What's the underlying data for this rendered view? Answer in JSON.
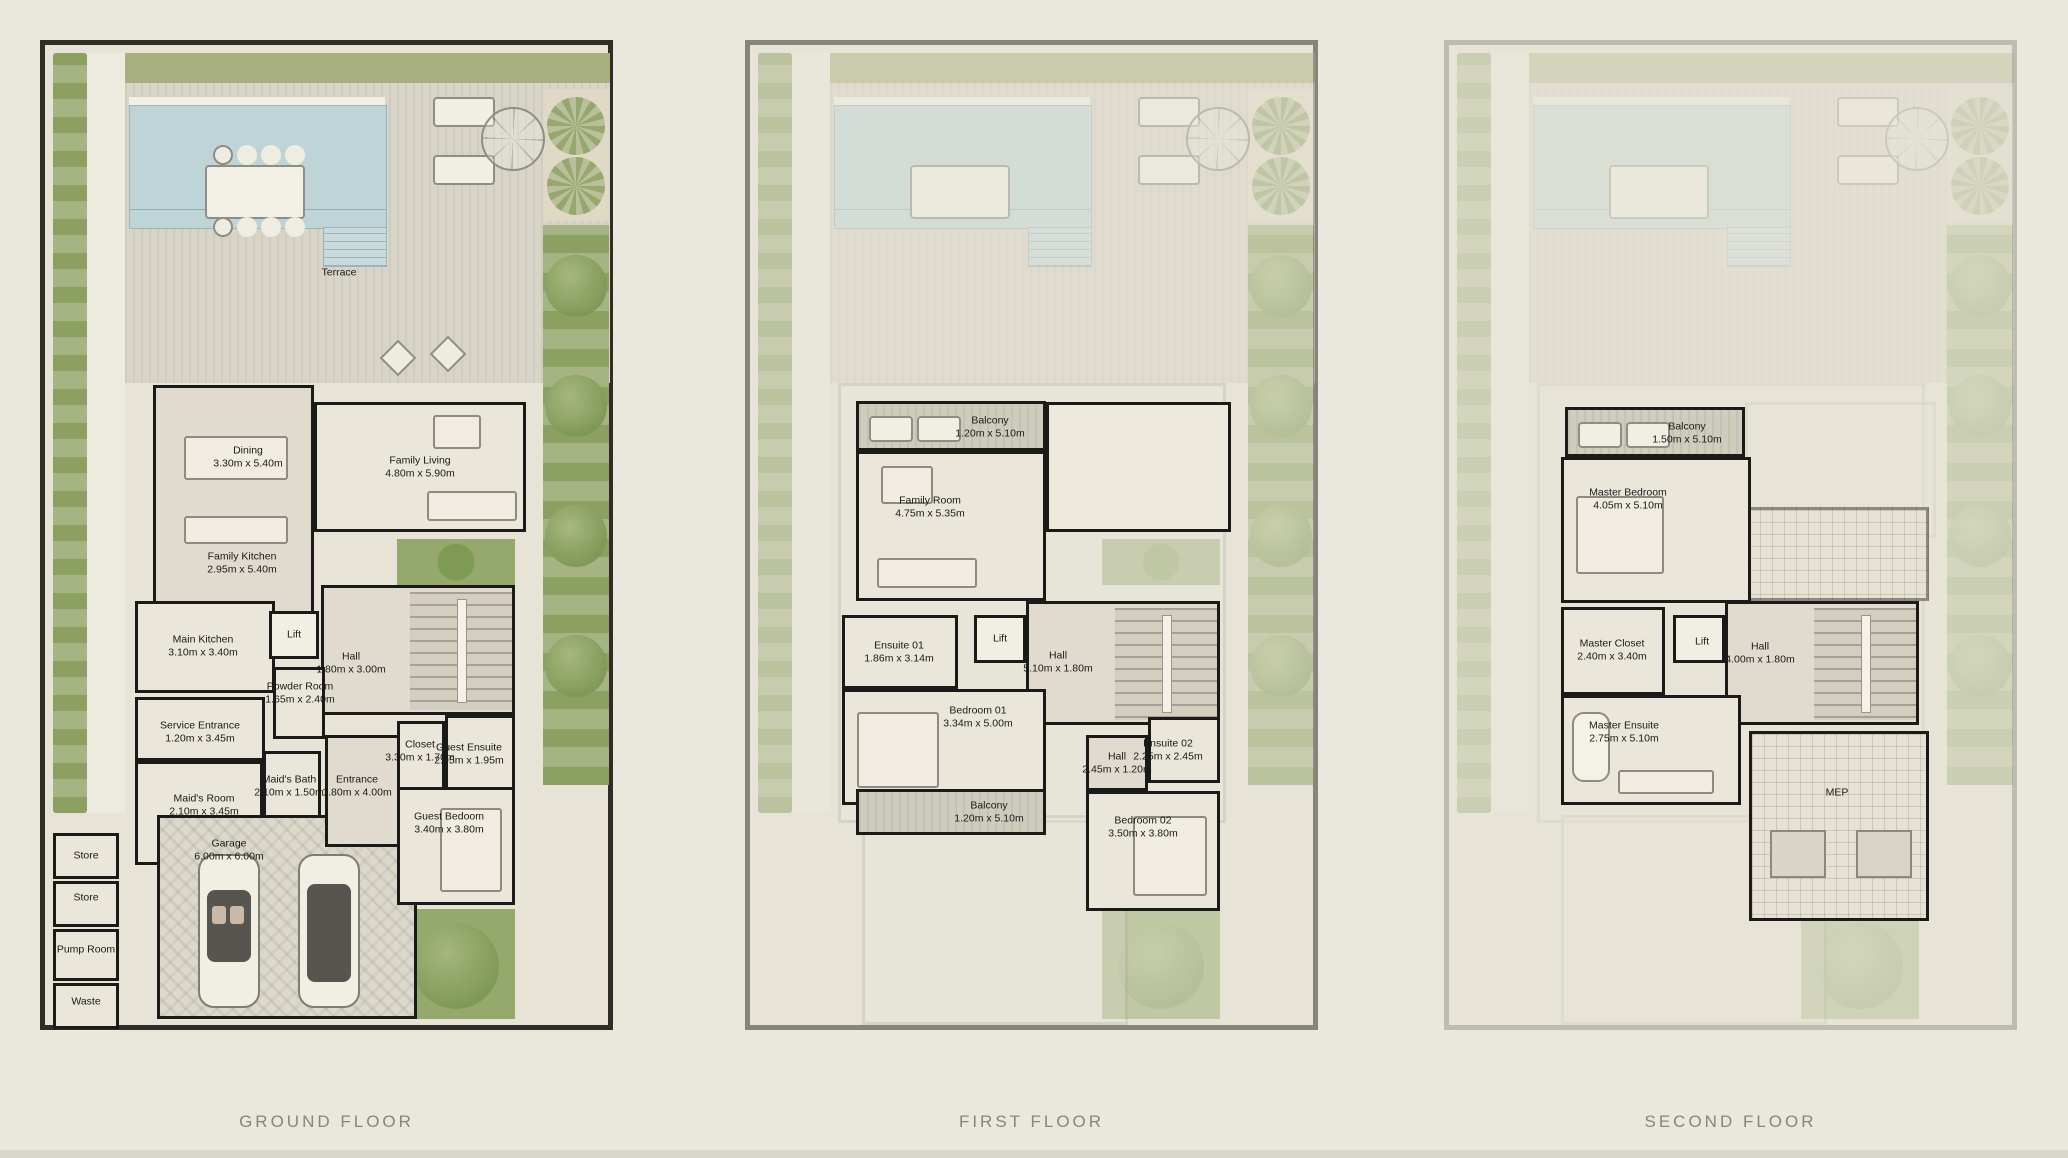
{
  "page": {
    "background_color": "#eae7dd",
    "description_labels": [
      "Terrace"
    ]
  },
  "colors": {
    "wall": "#1a1a18",
    "pool": "#bed4d6",
    "greenery": "#9fae78",
    "deck": "#d8d5c8",
    "frame_ground": "#2e2d29",
    "frame_first": "#85847e",
    "frame_second": "#bdbbb2",
    "title_text": "#8d8379",
    "label_text": "#191919"
  },
  "floors": [
    {
      "id": "ground",
      "title": "GROUND FLOOR",
      "labels": [
        {
          "name": "Terrace",
          "dims": "",
          "x": 294,
          "y": 228
        },
        {
          "name": "Dining",
          "dims": "3.30m x 5.40m",
          "x": 203,
          "y": 412
        },
        {
          "name": "Family Living",
          "dims": "4.80m x 5.90m",
          "x": 375,
          "y": 422
        },
        {
          "name": "Family Kitchen",
          "dims": "2.95m x 5.40m",
          "x": 197,
          "y": 518
        },
        {
          "name": "Main Kitchen",
          "dims": "3.10m x 3.40m",
          "x": 158,
          "y": 601
        },
        {
          "name": "Lift",
          "dims": "",
          "x": 249,
          "y": 590
        },
        {
          "name": "Hall",
          "dims": "1.80m x 3.00m",
          "x": 306,
          "y": 618
        },
        {
          "name": "Powder Room",
          "dims": "1.65m x 2.40m",
          "x": 255,
          "y": 648
        },
        {
          "name": "Service Entrance",
          "dims": "1.20m x 3.45m",
          "x": 155,
          "y": 687
        },
        {
          "name": "Maid's Bath",
          "dims": "2.10m x 1.50m",
          "x": 244,
          "y": 741
        },
        {
          "name": "Maid's Room",
          "dims": "2.10m x 3.45m",
          "x": 159,
          "y": 760
        },
        {
          "name": "Entrance",
          "dims": "1.80m x 4.00m",
          "x": 312,
          "y": 741
        },
        {
          "name": "Closet",
          "dims": "3.30m x 1.70m",
          "x": 375,
          "y": 706
        },
        {
          "name": "Guest Ensuite",
          "dims": "2.95m x 1.95m",
          "x": 424,
          "y": 709
        },
        {
          "name": "Guest Bedoom",
          "dims": "3.40m x 3.80m",
          "x": 404,
          "y": 778
        },
        {
          "name": "Garage",
          "dims": "6.00m x 6.00m",
          "x": 184,
          "y": 805
        },
        {
          "name": "Store",
          "dims": "",
          "x": 41,
          "y": 811
        },
        {
          "name": "Store",
          "dims": "",
          "x": 41,
          "y": 853
        },
        {
          "name": "Pump Room",
          "dims": "",
          "x": 41,
          "y": 905
        },
        {
          "name": "Waste",
          "dims": "",
          "x": 41,
          "y": 957
        }
      ]
    },
    {
      "id": "first",
      "title": "FIRST FLOOR",
      "labels": [
        {
          "name": "Balcony",
          "dims": "1.20m x 5.10m",
          "x": 240,
          "y": 382
        },
        {
          "name": "Family Room",
          "dims": "4.75m x 5.35m",
          "x": 180,
          "y": 462
        },
        {
          "name": "Ensuite 01",
          "dims": "1.86m x 3.14m",
          "x": 149,
          "y": 607
        },
        {
          "name": "Lift",
          "dims": "",
          "x": 250,
          "y": 594
        },
        {
          "name": "Hall",
          "dims": "5.10m x 1.80m",
          "x": 308,
          "y": 617
        },
        {
          "name": "Bedroom 01",
          "dims": "3.34m x 5.00m",
          "x": 228,
          "y": 672
        },
        {
          "name": "Hall",
          "dims": "2.45m x 1.20m",
          "x": 367,
          "y": 718
        },
        {
          "name": "Ensuite 02",
          "dims": "2.25m x 2.45m",
          "x": 418,
          "y": 705
        },
        {
          "name": "Balcony",
          "dims": "1.20m x 5.10m",
          "x": 239,
          "y": 767
        },
        {
          "name": "Bedroom 02",
          "dims": "3.50m x 3.80m",
          "x": 393,
          "y": 782
        }
      ]
    },
    {
      "id": "second",
      "title": "SECOND FLOOR",
      "labels": [
        {
          "name": "Balcony",
          "dims": "1.50m x 5.10m",
          "x": 238,
          "y": 388
        },
        {
          "name": "Master Bedroom",
          "dims": "4.05m x 5.10m",
          "x": 179,
          "y": 454
        },
        {
          "name": "Master Closet",
          "dims": "2.40m x 3.40m",
          "x": 163,
          "y": 605
        },
        {
          "name": "Lift",
          "dims": "",
          "x": 253,
          "y": 597
        },
        {
          "name": "Hall",
          "dims": "4.00m x 1.80m",
          "x": 311,
          "y": 608
        },
        {
          "name": "Master Ensuite",
          "dims": "2.75m x 5.10m",
          "x": 175,
          "y": 687
        },
        {
          "name": "MEP",
          "dims": "",
          "x": 388,
          "y": 748
        }
      ]
    }
  ]
}
